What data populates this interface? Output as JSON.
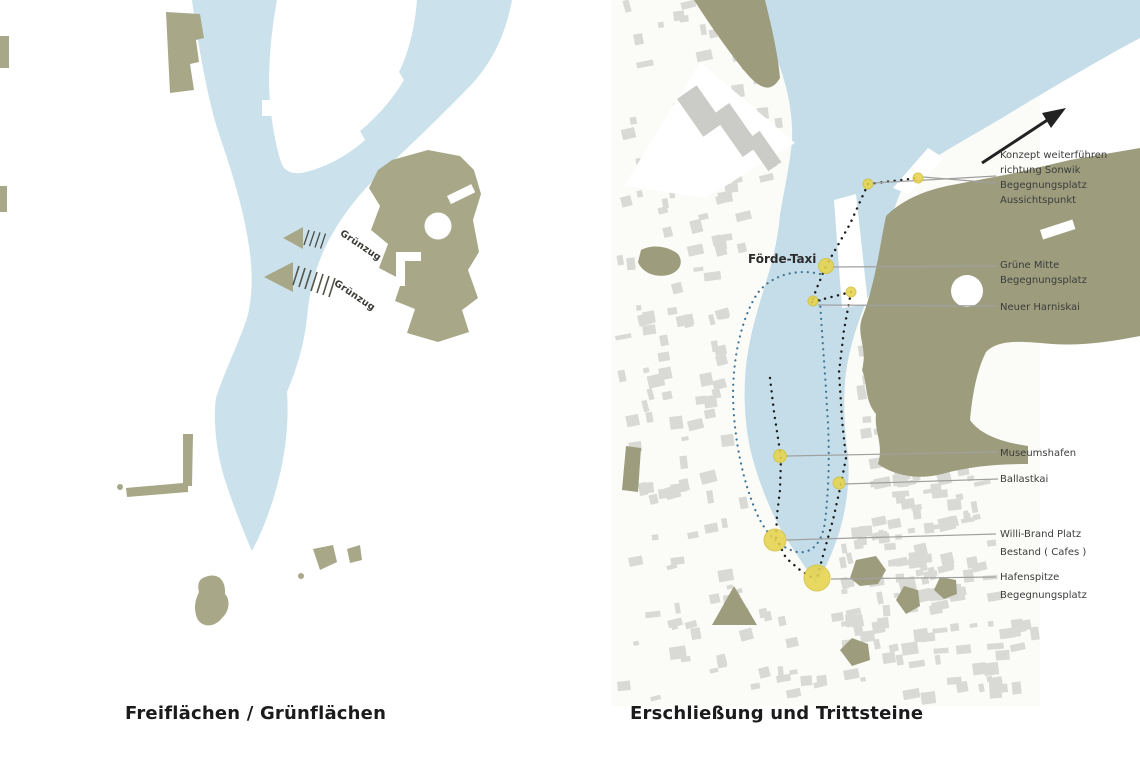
{
  "figure": {
    "left_caption": "Freiflächen / Grünflächen",
    "right_caption": "Erschließung und Trittsteine"
  },
  "left_map": {
    "arrow_labels": [
      "Grünzug",
      "Grünzug"
    ]
  },
  "right_map": {
    "water_label": "Förde-Taxi",
    "callouts": [
      {
        "lines": [
          "Konzept weiterführen",
          "richtung Sonwik",
          "Begegnungsplatz",
          "Aussichtspunkt"
        ]
      },
      {
        "lines": [
          "Grüne Mitte",
          "Begegnungsplatz"
        ]
      },
      {
        "lines": [
          "Neuer Harniskai"
        ]
      },
      {
        "lines": [
          "Museumshafen"
        ]
      },
      {
        "lines": [
          "Ballastkai"
        ]
      },
      {
        "lines": [
          "Willi-Brand Platz",
          "Bestand ( Cafes )"
        ]
      },
      {
        "lines": [
          "Hafenspitze",
          "Begegnungsplatz"
        ]
      }
    ]
  },
  "colors": {
    "water_left": "#cbe2ec",
    "water_right": "#c5dde8",
    "olive_left": "#a8a889",
    "olive_right": "#9d9d7e",
    "stop_yellow": "#e6d44d",
    "building_gray": "#d9d9d5",
    "leader_gray": "#a0a0a0",
    "route_black": "#1c1c1c",
    "ferry_blue": "#3f7596",
    "arrow_black": "#222222",
    "text_dark": "#1b1b1b",
    "label_gray": "#3c3c3c"
  }
}
